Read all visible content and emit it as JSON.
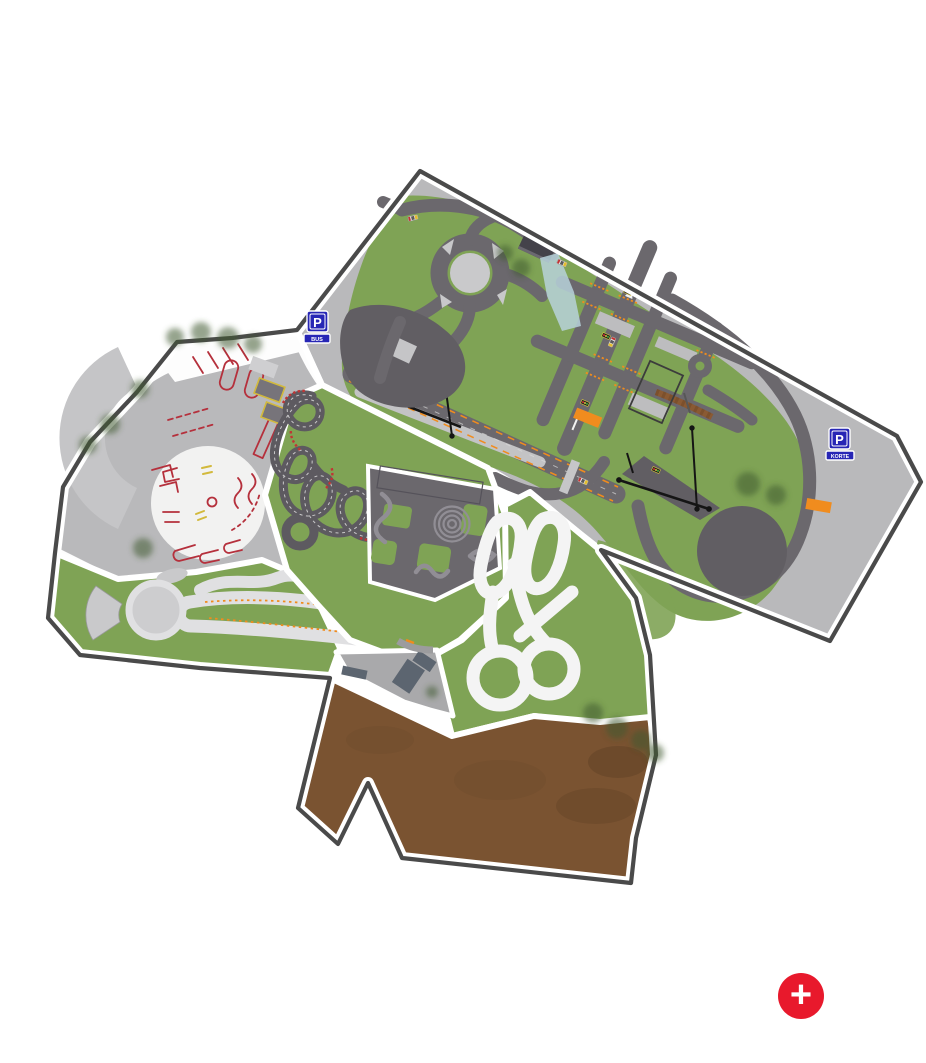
{
  "map": {
    "markers": {
      "bus_parking": {
        "letter": "P",
        "caption": "BUS"
      },
      "korte_parking": {
        "letter": "P",
        "caption": "KORTE"
      }
    },
    "controls": {
      "zoom_in": "+"
    }
  },
  "colors": {
    "background": "#ffffff",
    "outline": "#4a4a4a",
    "asphalt_light": "#b9b9bb",
    "asphalt_mid": "#a9a9ab",
    "road_dark": "#6b686d",
    "road_darker": "#615e63",
    "kart_track": "#5d5a60",
    "grass": "#7fa355",
    "grass_dark": "#6d9447",
    "tree": "#3e5a31",
    "dirt": "#7a5331",
    "dirt_dark": "#5e4026",
    "track_light": "#e0e0e2",
    "track_white": "#f4f4f4",
    "marking_red": "#b5303c",
    "marking_yellow": "#d2b93c",
    "marking_orange": "#f08c1e",
    "sign_blue": "#2726b5",
    "water": "#b7d2da",
    "building": "#5c6570",
    "fab_red": "#e8192c"
  }
}
